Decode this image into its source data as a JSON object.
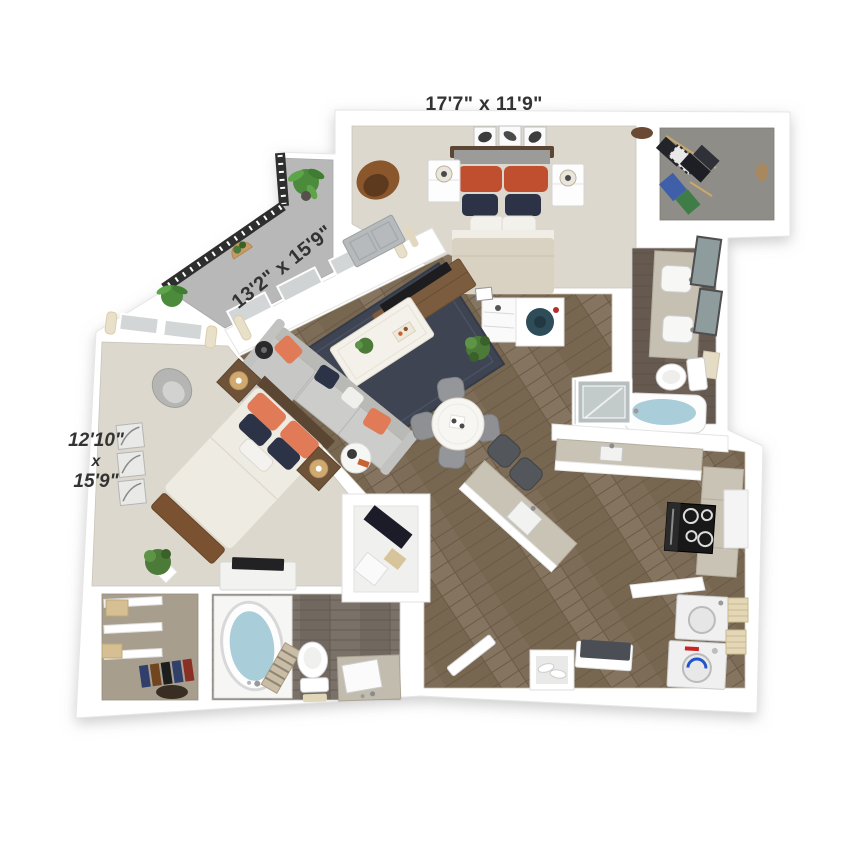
{
  "page": {
    "title": "3D apartment floor plan",
    "background": "#ffffff"
  },
  "floorplan": {
    "labels": {
      "master_bedroom": "17'7\" x 11'9\"",
      "living_room": "13'2\" x 15'9\"",
      "bedroom_2": [
        "12'10\"",
        "x",
        "15'9\""
      ]
    },
    "rooms": [
      "balcony",
      "master-bedroom",
      "walk-in-closet",
      "master-bathroom",
      "living-room",
      "dining-area",
      "kitchen",
      "laundry",
      "entry",
      "bedroom-2",
      "bathroom-2",
      "closet-2"
    ],
    "colors": {
      "wall": "#ffffff",
      "wood_floor": "#7d6c57",
      "carpet": "#dcd8cd",
      "closet_carpet": "#8f8d88",
      "bath_floor": "#6f6156",
      "balcony_floor": "#b8b8b8",
      "rug": "#3e4452",
      "sofa": "#cccccb",
      "pillow_red": "#bf4f2e",
      "pillow_salmon": "#e07a57",
      "navy_pillow": "#2c3347",
      "bed_duvet": "#d9d2c2",
      "counter_granite": "#c9c3b5",
      "water": "#a9cdd9",
      "railing": "#2e2e2e",
      "plant_green": "#4c7a38",
      "label_text": "#333333"
    }
  }
}
